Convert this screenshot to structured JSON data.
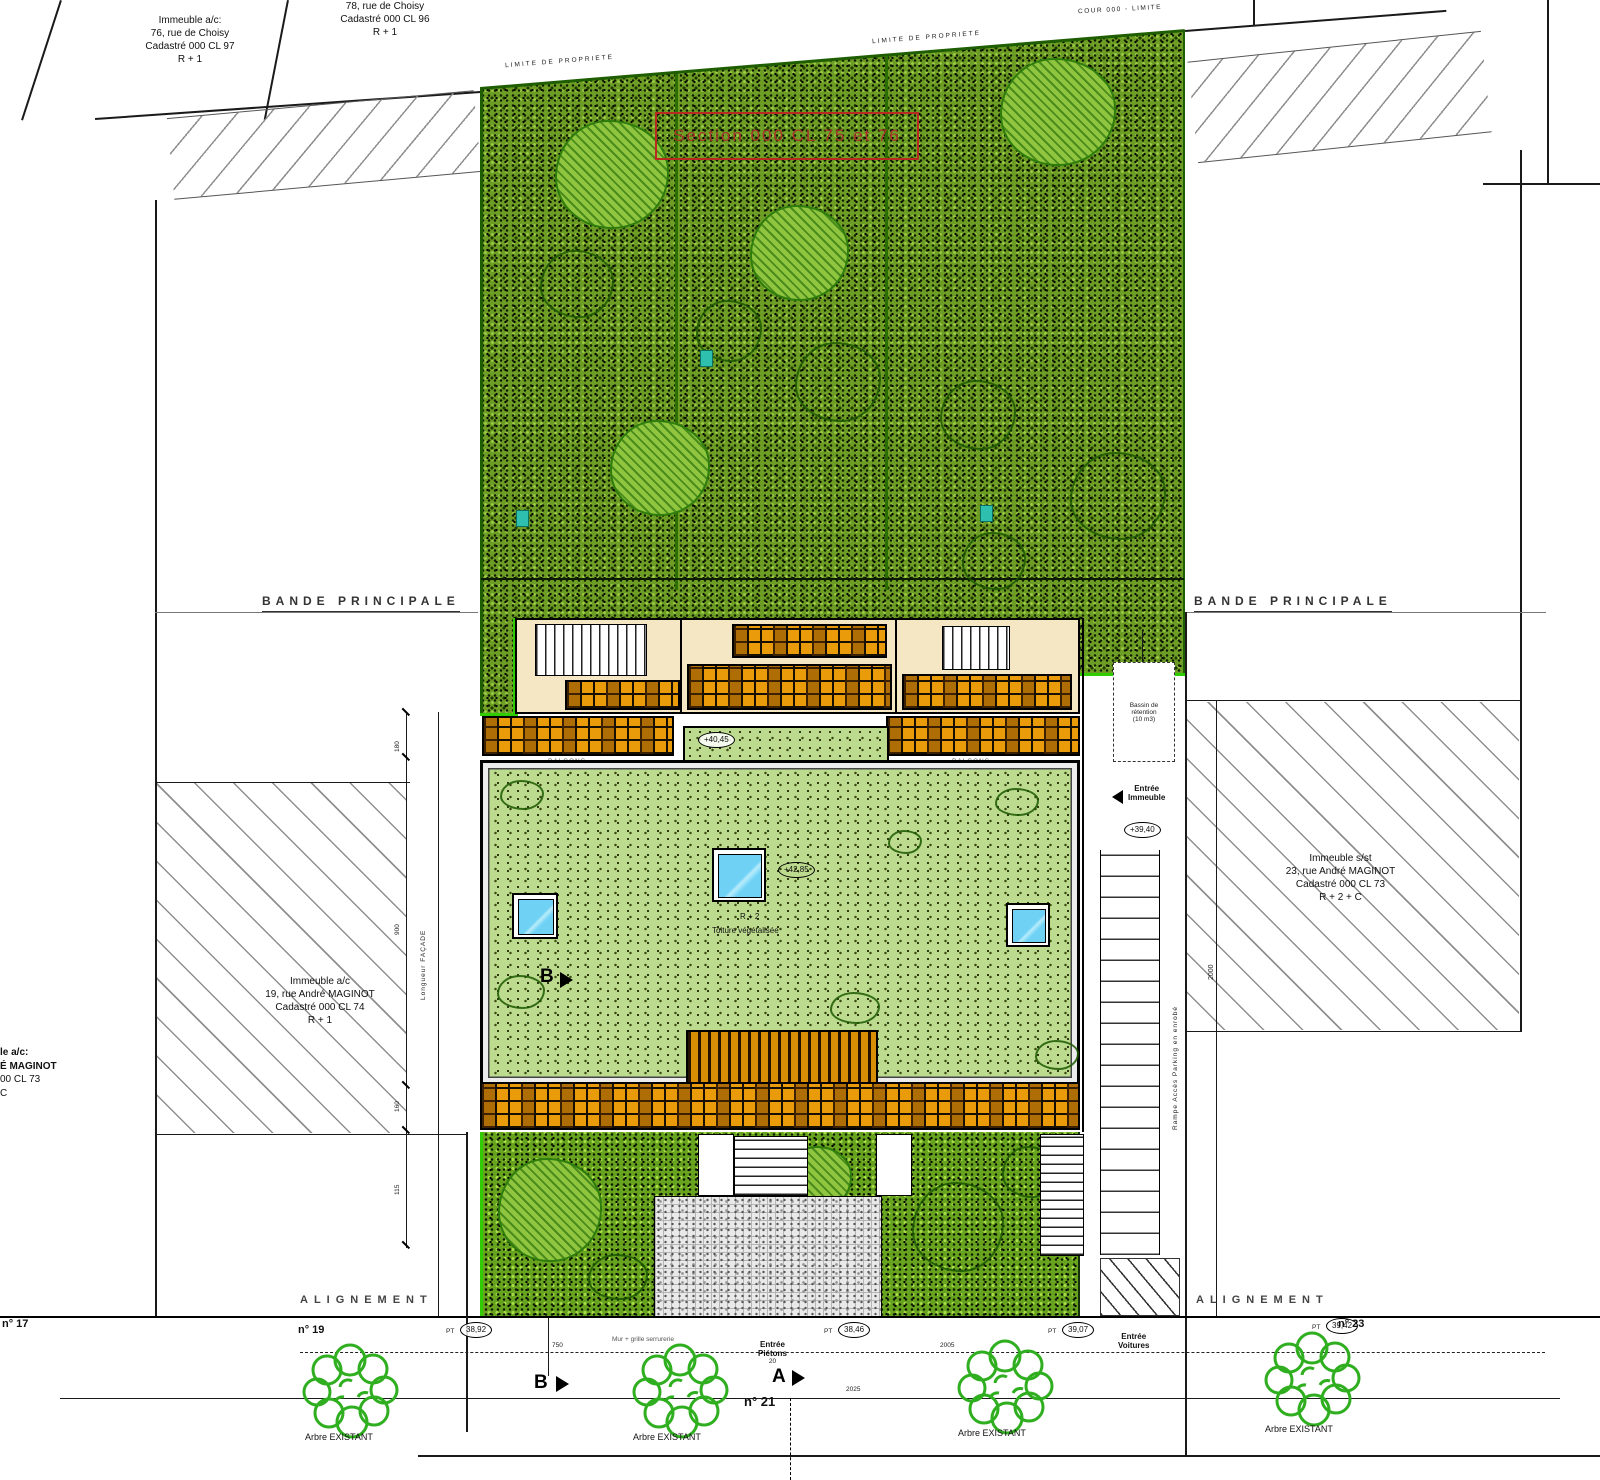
{
  "colors": {
    "garden_base": "#6d9d25",
    "garden_lime": "#2ecc00",
    "roof_green": "#bcdb8f",
    "balcony_orange": "#e99b0a",
    "skylight_blue": "#6fd2f5",
    "section_red": "#b23226",
    "hatch_gray": "#8f8f8f"
  },
  "labels": {
    "limite_propriete_1": "LIMITE DE PROPRIETE",
    "limite_propriete_2": "LIMITE DE PROPRIETE",
    "cour": "COUR 000 - LIMITE",
    "section": "Section 000 CL 75 et 76",
    "bande_principale_left": "BANDE PRINCIPALE",
    "bande_principale_right": "BANDE PRINCIPALE",
    "alignement_left": "ALIGNEMENT",
    "alignement_right": "ALIGNEMENT",
    "arbre": "Arbre EXISTANT",
    "balcons": "BALCONS",
    "roof_line1": "R + 2",
    "roof_line2": "Toiture végétalisée",
    "bassin_l1": "Bassin de",
    "bassin_l2": "rétention",
    "bassin_l3": "(10 m3)",
    "entree_immeuble_l1": "Entrée",
    "entree_immeuble_l2": "Immeuble",
    "entree_pietons_l1": "Entrée",
    "entree_pietons_l2": "Piétons",
    "entree_pietons_dim": "20",
    "entree_voitures_l1": "Entrée",
    "entree_voitures_l2": "Voitures",
    "rampe": "Rampe Accès Parking en enrobé",
    "mur": "Mur + grille serrurerie",
    "facade": "Longueur FAÇADE",
    "pt": "PT"
  },
  "parcels": {
    "top_left": {
      "l1": "Immeuble a/c:",
      "l2": "76, rue de Choisy",
      "l3": "Cadastré 000 CL 97",
      "l4": "R + 1"
    },
    "top_mid": {
      "l1": "78, rue de Choisy",
      "l2": "Cadastré 000 CL 96",
      "l3": "R + 1"
    },
    "left": {
      "l1": "Immeuble a/c",
      "l2": "19, rue André MAGINOT",
      "l3": "Cadastré 000 CL 74",
      "l4": "R + 1"
    },
    "right": {
      "l1": "Immeuble s/st",
      "l2": "23, rue André MAGINOT",
      "l3": "Cadastré 000 CL 73",
      "l4": "R + 2 + C"
    },
    "far_left": {
      "l1": "le a/c:",
      "l2": "É MAGINOT",
      "l3": "00 CL 73",
      "l4": "C"
    }
  },
  "levels": {
    "entree": "+39,40",
    "terrasse": "+42,85",
    "palier": "+40,45",
    "pt1": "38,92",
    "pt2": "38,46",
    "pt3": "39,07",
    "pt4": "39,42"
  },
  "house_numbers": {
    "n17": "n° 17",
    "n19": "n° 19",
    "n21": "n° 21",
    "n23": "n° 23"
  },
  "markers": {
    "a": "A",
    "b": "B",
    "b_top": "B"
  },
  "dims": {
    "d1": "180",
    "d2": "900",
    "d3": "160",
    "d4": "115",
    "v_right": "2000",
    "s1": "750",
    "s2": "2005",
    "s3": "2025"
  }
}
